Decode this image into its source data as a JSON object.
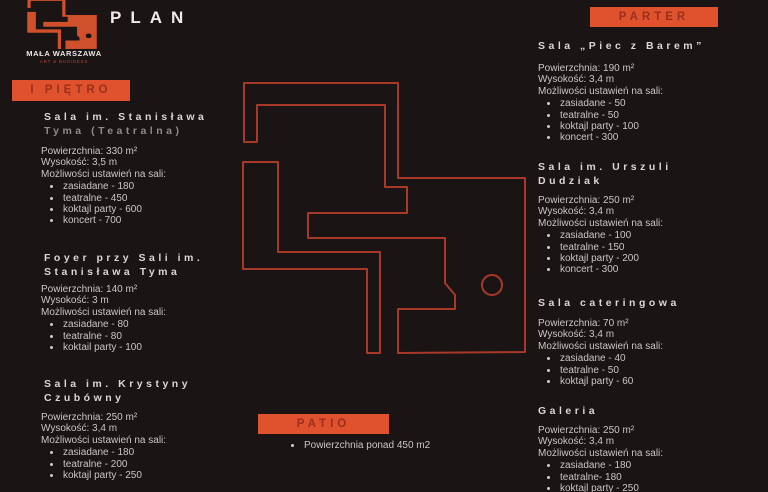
{
  "colors": {
    "background": "#1a1414",
    "accent": "#e0522e",
    "badge_text": "#9c2f1d",
    "plan_line": "#a83828",
    "heading": "#d9d6d4",
    "heading_dim": "#8c8c8c",
    "body_text": "#c9c6c4",
    "logo_fill": "#d0502c"
  },
  "header": {
    "title": "PLAN",
    "brand": "MAŁA WARSZAWA",
    "tagline": "ART & BUSINESS"
  },
  "floor1": {
    "badge": "I PIĘTRO",
    "sections": [
      {
        "title1": "Sala im. Stanisława",
        "title2": "Tyma (Teatralna)",
        "area": "Powierzchnia: 330 m²",
        "height": "Wysokość: 3,5 m",
        "options_label": "Możliwości ustawień na sali:",
        "options": [
          "zasiadane - 180",
          "teatralne - 450",
          "koktajl party - 600",
          "koncert - 700"
        ]
      },
      {
        "title1": "Foyer przy Sali im.",
        "title2": "Stanisława Tyma",
        "area": "Powierzchnia: 140 m²",
        "height": "Wysokość: 3 m",
        "options_label": "Możliwości ustawień na sali:",
        "options": [
          "zasiadane - 80",
          "teatralne - 80",
          "koktail party - 100"
        ]
      },
      {
        "title1": "Sala im. Krystyny",
        "title2": "Czubówny",
        "area": "Powierzchnia: 250 m²",
        "height": "Wysokość: 3,4 m",
        "options_label": "Możliwości ustawień na sali:",
        "options": [
          "zasiadane - 180",
          "teatralne - 200",
          "koktajl party - 250"
        ]
      }
    ]
  },
  "ground_floor": {
    "badge": "PARTER",
    "sections": [
      {
        "title1": "Sala „Piec z Barem”",
        "title2": "",
        "area": "Powierzchnia: 190 m²",
        "height": "Wysokość: 3,4 m",
        "options_label": "Możliwości ustawień na sali:",
        "options": [
          "zasiadane - 50",
          "teatralne - 50",
          "koktajl party - 100",
          "koncert - 300"
        ]
      },
      {
        "title1": "Sala im. Urszuli",
        "title2": "Dudziak",
        "area": "Powierzchnia: 250 m²",
        "height": "Wysokość: 3,4 m",
        "options_label": "Możliwości ustawień na sali:",
        "options": [
          "zasiadane - 100",
          "teatralne - 150",
          "koktajl party - 200",
          "koncert - 300"
        ]
      },
      {
        "title1": "Sala cateringowa",
        "title2": "",
        "area": "Powierzchnia: 70 m²",
        "height": "Wysokość: 3,4 m",
        "options_label": "Możliwości ustawień na sali:",
        "options": [
          "zasiadane - 40",
          "teatralne - 50",
          "koktajl party - 60"
        ]
      },
      {
        "title1": "Galeria",
        "title2": "",
        "area": "Powierzchnia: 250 m²",
        "height": "Wysokość: 3,4 m",
        "options_label": "Możliwości ustawień na sali:",
        "options": [
          "zasiadane - 180",
          "teatralne- 180",
          "koktajl party - 250"
        ]
      }
    ]
  },
  "patio": {
    "badge": "PATIO",
    "note": "Powierzchnia ponad 450 m2"
  }
}
